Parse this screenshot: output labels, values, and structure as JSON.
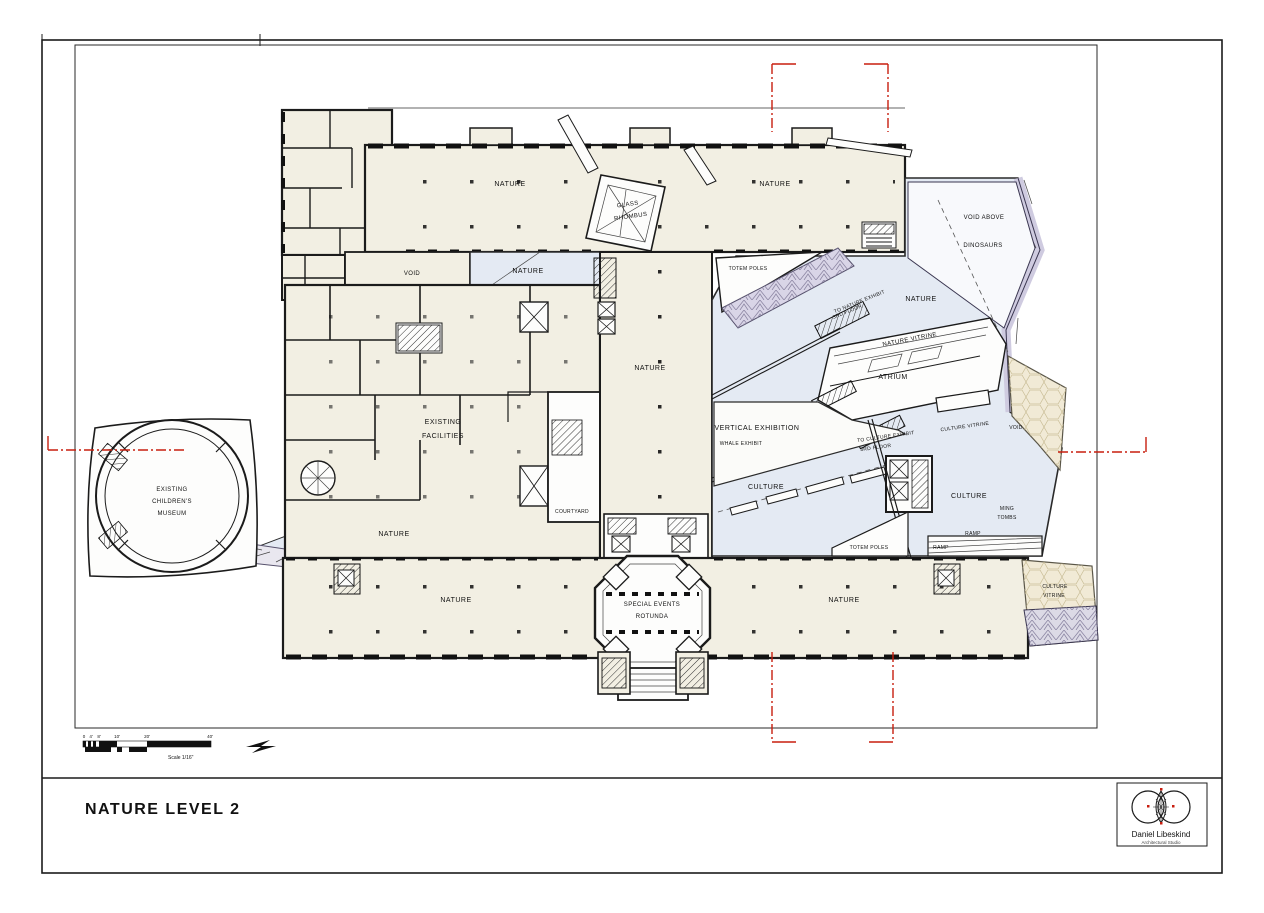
{
  "sheet": {
    "title": "NATURE LEVEL 2",
    "scale_label": "Scale 1/16\"",
    "scale_ticks": [
      "0",
      "4'",
      "8'",
      "10'",
      "20'",
      "40'"
    ],
    "logo": {
      "name": "Daniel Libeskind",
      "subtitle": "Architectural Studio"
    }
  },
  "colors": {
    "cream_floor": "#f2efe3",
    "crystal_blue": "#e4eaf3",
    "crystal_tan": "#f1ead6",
    "facet_purple": "#d9d5e7",
    "section_red": "#c81e0f",
    "wall_black": "#1b1b1b"
  },
  "plan": {
    "labels": {
      "nature_nw": "NATURE",
      "nature_ne": "NATURE",
      "glass_rhombus_1": "GLASS",
      "glass_rhombus_2": "RHOMBUS",
      "void_nw": "VOID",
      "nature_mid_upper": "NATURE",
      "totem_poles_upper": "TOTEM POLES",
      "void_above": "VOID ABOVE",
      "dinosaurs": "DINOSAURS",
      "nature_crystal": "NATURE",
      "to_nature_exhibit_1": "TO NATURE EXHIBIT",
      "to_nature_exhibit_2": "3RD FLOOR",
      "nature_vitrine": "NATURE VITRINE",
      "atrium": "ATRIUM",
      "existing_facilities_1": "EXISTING",
      "existing_facilities_2": "FACILITIES",
      "vertical_exhibition": "VERTICAL EXHIBITION",
      "whale_exhibit": "WHALE EXHIBIT",
      "to_culture_exhibit_1": "TO CULTURE EXHIBIT",
      "to_culture_exhibit_2": "3RD FLOOR",
      "culture_vitrine_east": "CULTURE VITRINE",
      "void_east": "VOID",
      "nature_corridor": "NATURE",
      "culture_west": "CULTURE",
      "culture_east": "CULTURE",
      "ming_tombs_1": "MING",
      "ming_tombs_2": "TOMBS",
      "ramp_a": "RAMP",
      "ramp_b": "RAMP",
      "childrens_museum_1": "EXISTING",
      "childrens_museum_2": "CHILDREN'S",
      "childrens_museum_3": "MUSEUM",
      "nature_plaza": "NATURE",
      "courtyard": "COURTYARD",
      "totem_poles_lower": "TOTEM POLES",
      "nature_sw": "NATURE",
      "rotunda_1": "SPECIAL EVENTS",
      "rotunda_2": "ROTUNDA",
      "nature_se": "NATURE",
      "culture_vitrine_south_1": "CULTURE",
      "culture_vitrine_south_2": "VITRINE"
    }
  }
}
